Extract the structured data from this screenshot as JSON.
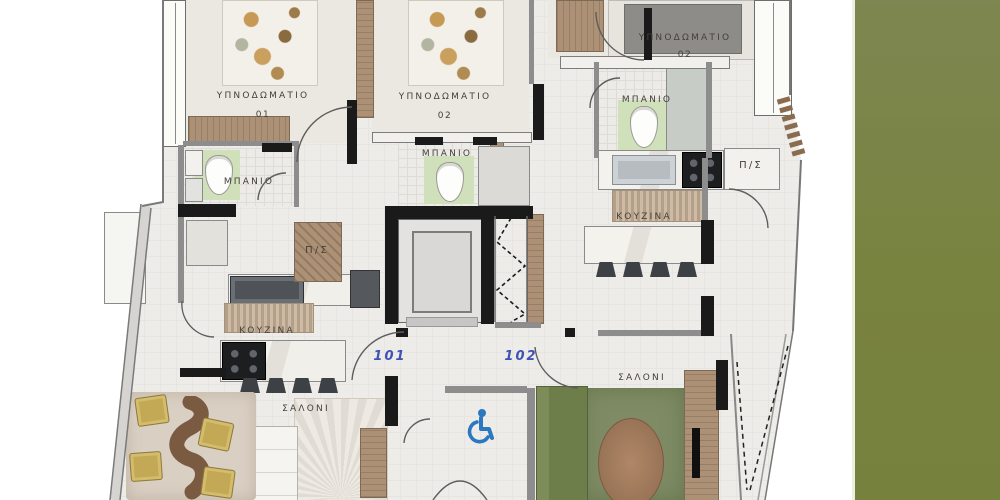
{
  "side_panel": {
    "top_color": "#7e8651",
    "bottom_color": "#76813d"
  },
  "plan": {
    "labels": {
      "bedroom_left": {
        "name": "ΥΠΝΟΔΩΜΑΤΙΟ",
        "number": "01"
      },
      "bedroom_mid": {
        "name": "ΥΠΝΟΔΩΜΑΤΙΟ",
        "number": "02"
      },
      "bedroom_right": {
        "name": "ΥΠΝΟΔΩΜΑΤΙΟ",
        "number": "02"
      },
      "bath_left": "ΜΠΑΝΙΟ",
      "bath_mid": "ΜΠΑΝΙΟ",
      "bath_right": "ΜΠΑΝΙΟ",
      "kitchen_left": "ΚΟΥΖΙΝΑ",
      "kitchen_right": "ΚΟΥΖΙΝΑ",
      "living_left": "ΣΑΛΟΝΙ",
      "living_right": "ΣΑΛΟΝΙ",
      "storage_left": "Π/Σ",
      "storage_right": "Π/Σ"
    },
    "units": {
      "left": "101",
      "right": "102"
    },
    "colors": {
      "unit_number": "#3f51b5",
      "accessibility": "#2b77c0",
      "wall": "#1a1a1a",
      "sofa_green": "#6e7e4a",
      "rug_green": "#7e8b64"
    },
    "icons": {
      "accessibility": "wheelchair-accessibility-icon"
    }
  }
}
